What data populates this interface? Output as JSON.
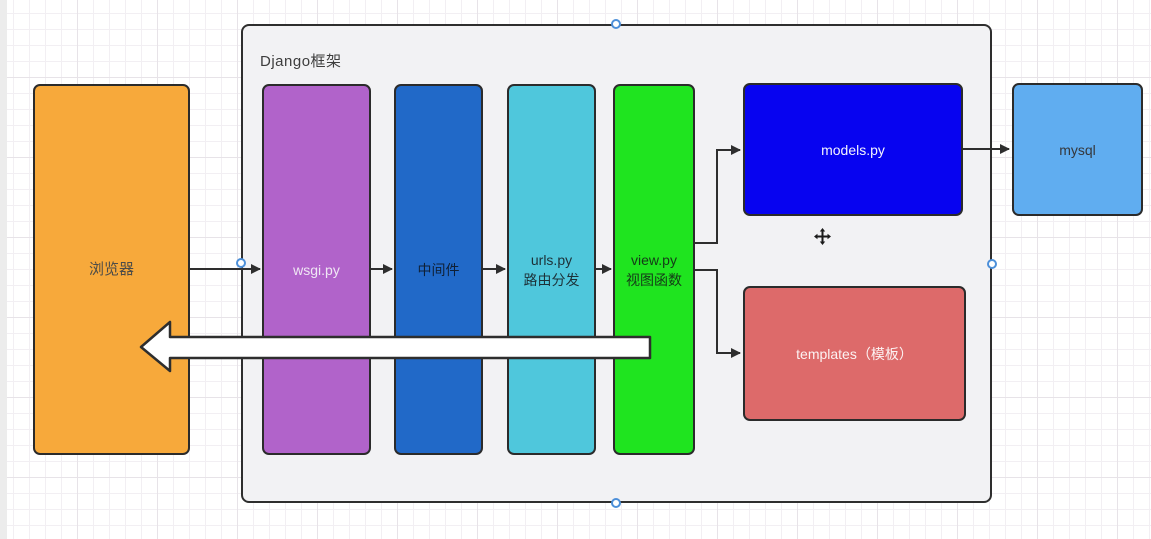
{
  "canvas": {
    "background": "#FFFFFF",
    "grid_minor_color": "#F2EFF3",
    "grid_major_color": "#E7E3E8"
  },
  "container": {
    "label": "Django框架",
    "fill": "#F2F2F4",
    "border_color": "#2E2E2E",
    "label_color": "#3D3D3D"
  },
  "nodes": {
    "browser": {
      "label": "浏览器",
      "fill": "#F7A93B",
      "text_color": "#4D4C48"
    },
    "wsgi": {
      "label": "wsgi.py",
      "fill": "#B163CA",
      "text_color": "#F0E7F4"
    },
    "middleware": {
      "label": "中间件",
      "fill": "#2169C8",
      "text_color": "#0F2036"
    },
    "urls": {
      "line1": "urls.py",
      "line2": "路由分发",
      "fill": "#4FC7DC",
      "text_color": "#1D3138"
    },
    "view": {
      "line1": "view.py",
      "line2": "视图函数",
      "fill": "#1FE41F",
      "text_color": "#153A18"
    },
    "models": {
      "label": "models.py",
      "fill": "#0703F0",
      "text_color": "#F4F4FE"
    },
    "templates": {
      "label": "templates（模板）",
      "fill": "#DD6A6A",
      "text_color": "#FCF2F2"
    },
    "mysql": {
      "label": "mysql",
      "fill": "#60ADF0",
      "text_color": "#35373B"
    }
  },
  "connectors": {
    "color": "#2E2E2E",
    "list": [
      "browser-to-wsgi",
      "wsgi-to-middleware",
      "middleware-to-urls",
      "urls-to-view",
      "view-to-models",
      "view-to-templates",
      "models-to-mysql"
    ]
  },
  "return_arrow": {
    "fill": "#FFFFFF",
    "outline": "#2E2E2E"
  },
  "selection": {
    "handle_fill": "#FFFFFF",
    "handle_ring": "#4C8FD9"
  },
  "cursor": {
    "move_icon_color": "#1A1A1A"
  }
}
